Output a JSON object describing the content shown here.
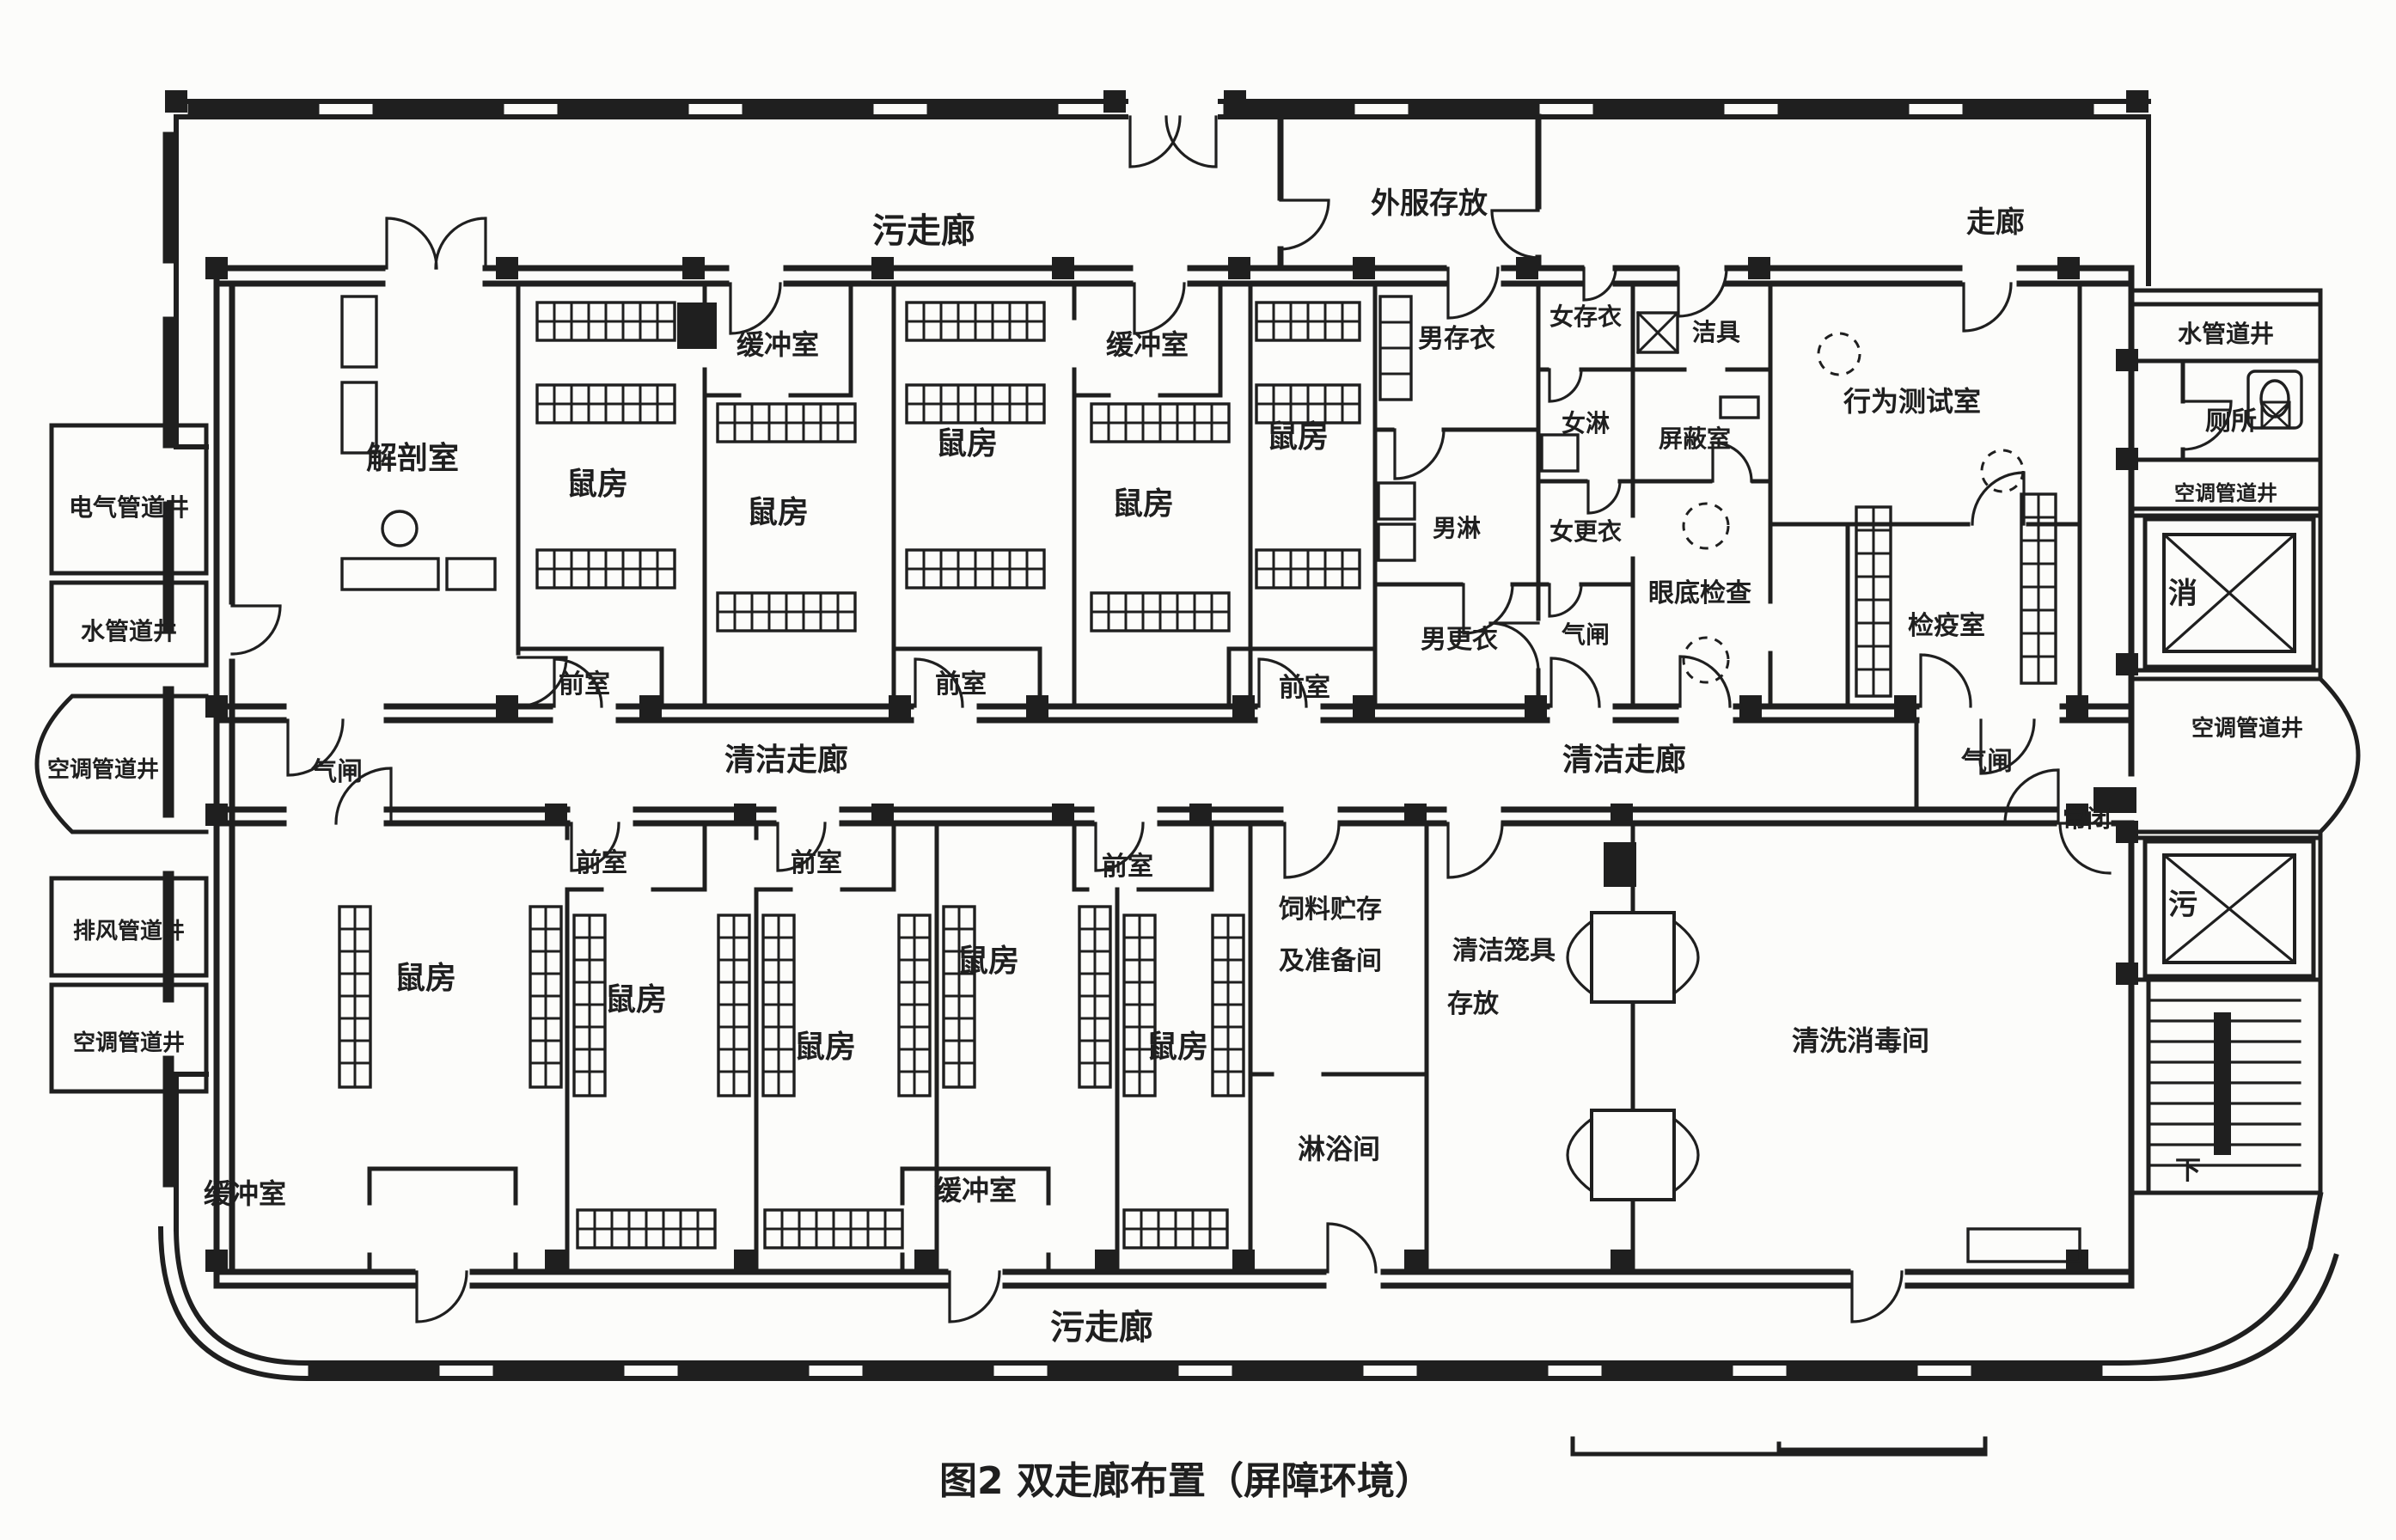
{
  "figure": {
    "caption": "图2 双走廊布置（屏障环境）",
    "type": "architectural-floor-plan",
    "colors": {
      "ink": "#1f1f1f",
      "paper": "#fcfcfa"
    }
  },
  "labels": {
    "dirtyCorridor": "污走廊",
    "cleanCorridor": "清洁走廊",
    "corridor": "走廊",
    "outerClothesStorage": "外服存放",
    "dissectionRoom": "解剖室",
    "mouseRoom": "鼠房",
    "bufferRoom": "缓冲室",
    "anteroom": "前室",
    "airlock": "气闸",
    "menClothesStorage": "男存衣",
    "womenClothesStorage": "女存衣",
    "cleaningTools": "洁具",
    "womenShower": "女淋",
    "menShower": "男淋",
    "womenChanging": "女更衣",
    "menChanging": "男更衣",
    "shieldedRoom": "屏蔽室",
    "behaviorTestRoom": "行为测试室",
    "fundusExamRoom": "眼底检查",
    "quarantineRoom": "检疫室",
    "normallyClosed": "常闭",
    "feedStorageLine1": "饲料贮存",
    "feedStorageLine2": "及准备间",
    "showerRoom": "淋浴间",
    "cleanCageStorageLine1": "清洁笼具",
    "cleanCageStorageLine2": "存放",
    "washDisinfectionRoom": "清洗消毒间",
    "electricalShaft": "电气管道井",
    "waterShaft": "水管道井",
    "acShaft": "空调管道井",
    "exhaustShaft": "排风管道井",
    "toilet": "厕所",
    "elevatorDisinfection": "消",
    "elevatorDirty": "污",
    "stairDown": "下"
  }
}
